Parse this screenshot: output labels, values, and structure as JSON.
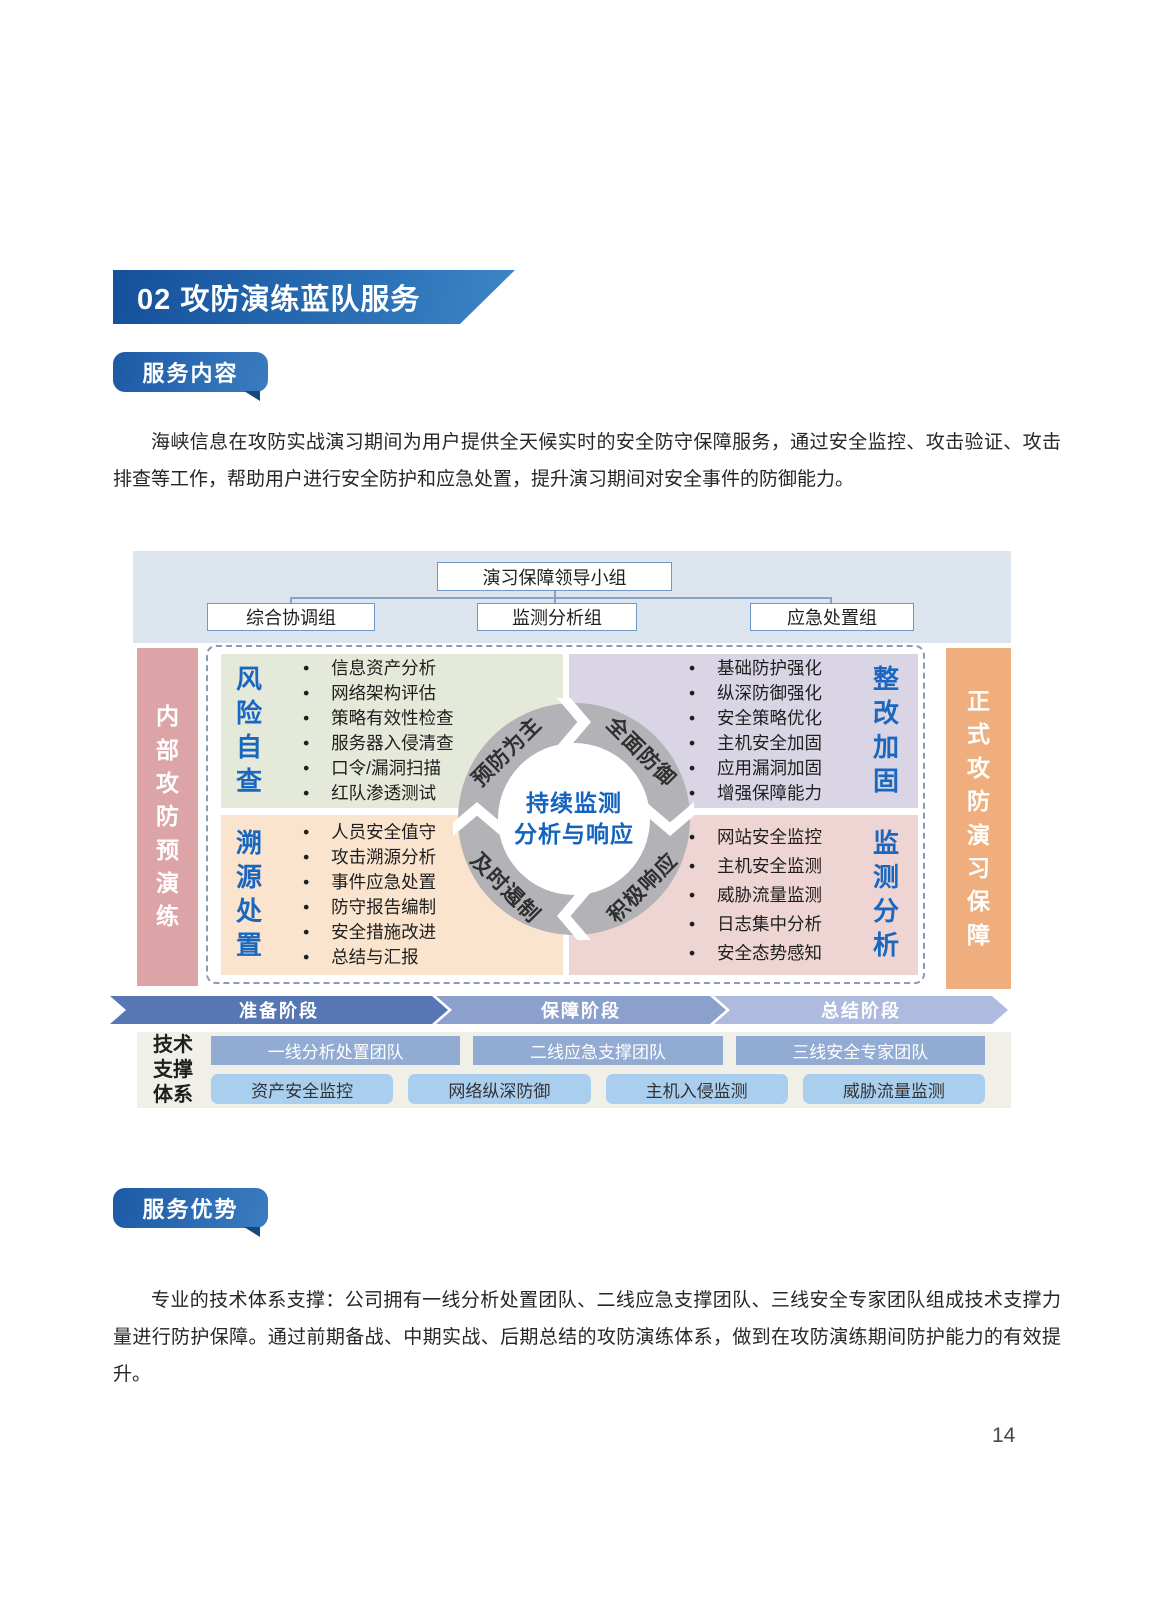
{
  "page": {
    "number": "14",
    "heading": "02 攻防演练蓝队服务",
    "sections": [
      {
        "ribbon": "服务内容"
      },
      {
        "ribbon": "服务优势"
      }
    ],
    "paragraph1": "海峡信息在攻防实战演习期间为用户提供全天候实时的安全防守保障服务，通过安全监控、攻击验证、攻击排查等工作，帮助用户进行安全防护和应急处置，提升演习期间对安全事件的防御能力。",
    "paragraph2": "专业的技术体系支撑：公司拥有一线分析处置团队、二线应急支撑团队、三线安全专家团队组成技术支撑力量进行防护保障。通过前期备战、中期实战、后期总结的攻防演练体系，做到在攻防演练期间防护能力的有效提升。"
  },
  "diagram": {
    "org_chart": {
      "root": "演习保障领导小组",
      "groups": [
        "综合协调组",
        "监测分析组",
        "应急处置组"
      ]
    },
    "left_bar": "内部攻防预演练",
    "right_bar": "正式攻防演习保障",
    "quadrants": [
      {
        "title": "风险自查",
        "items": [
          "信息资产分析",
          "网络架构评估",
          "策略有效性检查",
          "服务器入侵清查",
          "口令/漏洞扫描",
          "红队渗透测试"
        ]
      },
      {
        "title": "整改加固",
        "items": [
          "基础防护强化",
          "纵深防御强化",
          "安全策略优化",
          "主机安全加固",
          "应用漏洞加固",
          "增强保障能力"
        ]
      },
      {
        "title": "溯源处置",
        "items": [
          "人员安全值守",
          "攻击溯源分析",
          "事件应急处置",
          "防守报告编制",
          "安全措施改进",
          "总结与汇报"
        ]
      },
      {
        "title": "监测分析",
        "items": [
          "网站安全监控",
          "主机安全监测",
          "威胁流量监测",
          "日志集中分析",
          "安全态势感知"
        ]
      }
    ],
    "cycle": {
      "center_line1": "持续监测",
      "center_line2": "分析与响应",
      "segments": [
        "预防为主",
        "全面防御",
        "及时遏制",
        "积极响应"
      ]
    },
    "phases": [
      "准备阶段",
      "保障阶段",
      "总结阶段"
    ],
    "tech_support": {
      "label": "技术支撑体系",
      "teams": [
        "一线分析处置团队",
        "二线应急支撑团队",
        "三线安全专家团队"
      ],
      "capabilities": [
        "资产安全监控",
        "网络纵深防御",
        "主机入侵监测",
        "威胁流量监测"
      ]
    }
  },
  "colors": {
    "banner_blue": "#15509b",
    "ribbon_blue": "#2b6cb4",
    "org_band_blue": "#dce4ee",
    "left_bar_pink": "#dda4a8",
    "right_bar_orange": "#f0ad7e",
    "quad_green": "#e4e9d9",
    "quad_purple": "#dad5e4",
    "quad_peach": "#fbe4cd",
    "quad_rose": "#eed5d3",
    "ring_gray": "#b3b3b7",
    "accent_blue": "#1a67c0",
    "phase_dark": "#5677b4",
    "phase_mid": "#8ba0cc",
    "phase_light": "#aebbdf",
    "team_blue": "#91abd3",
    "capability_blue": "#a9ceee",
    "tech_bg": "#f1f0e8"
  }
}
